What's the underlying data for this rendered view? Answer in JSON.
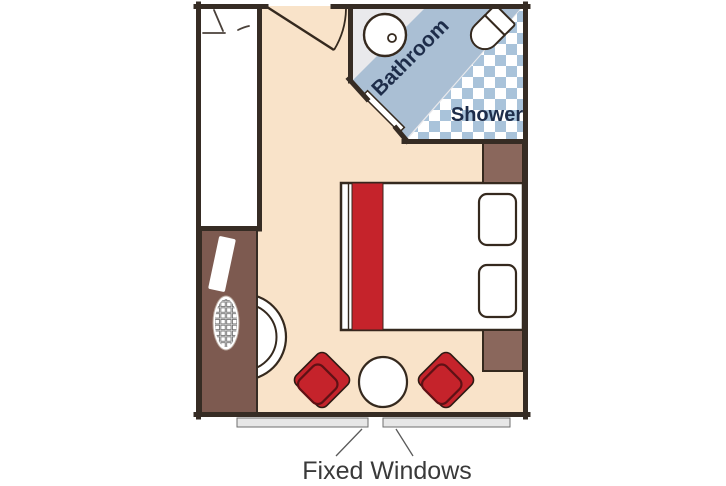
{
  "labels": {
    "bathroom": "Bathroom",
    "shower": "Shower",
    "fixed_windows": "Fixed Windows"
  },
  "colors": {
    "floor": "#f9e3c9",
    "wall": "#362c24",
    "closet": "#ffffff",
    "desk-brown": "#7d5a50",
    "nightstand-brown": "#8a675c",
    "accent-red": "#c5232b",
    "red-dark-stroke": "#5f1115",
    "bath-floor": "#e9e9ec",
    "bath-counter-blue": "#aabfd4",
    "checker-blue": "#a9c3da",
    "navy-text": "#1e2d4a",
    "window-gray": "#e7e7e7",
    "label-text": "#3a3a3a",
    "furniture-stroke": "#35291e"
  }
}
